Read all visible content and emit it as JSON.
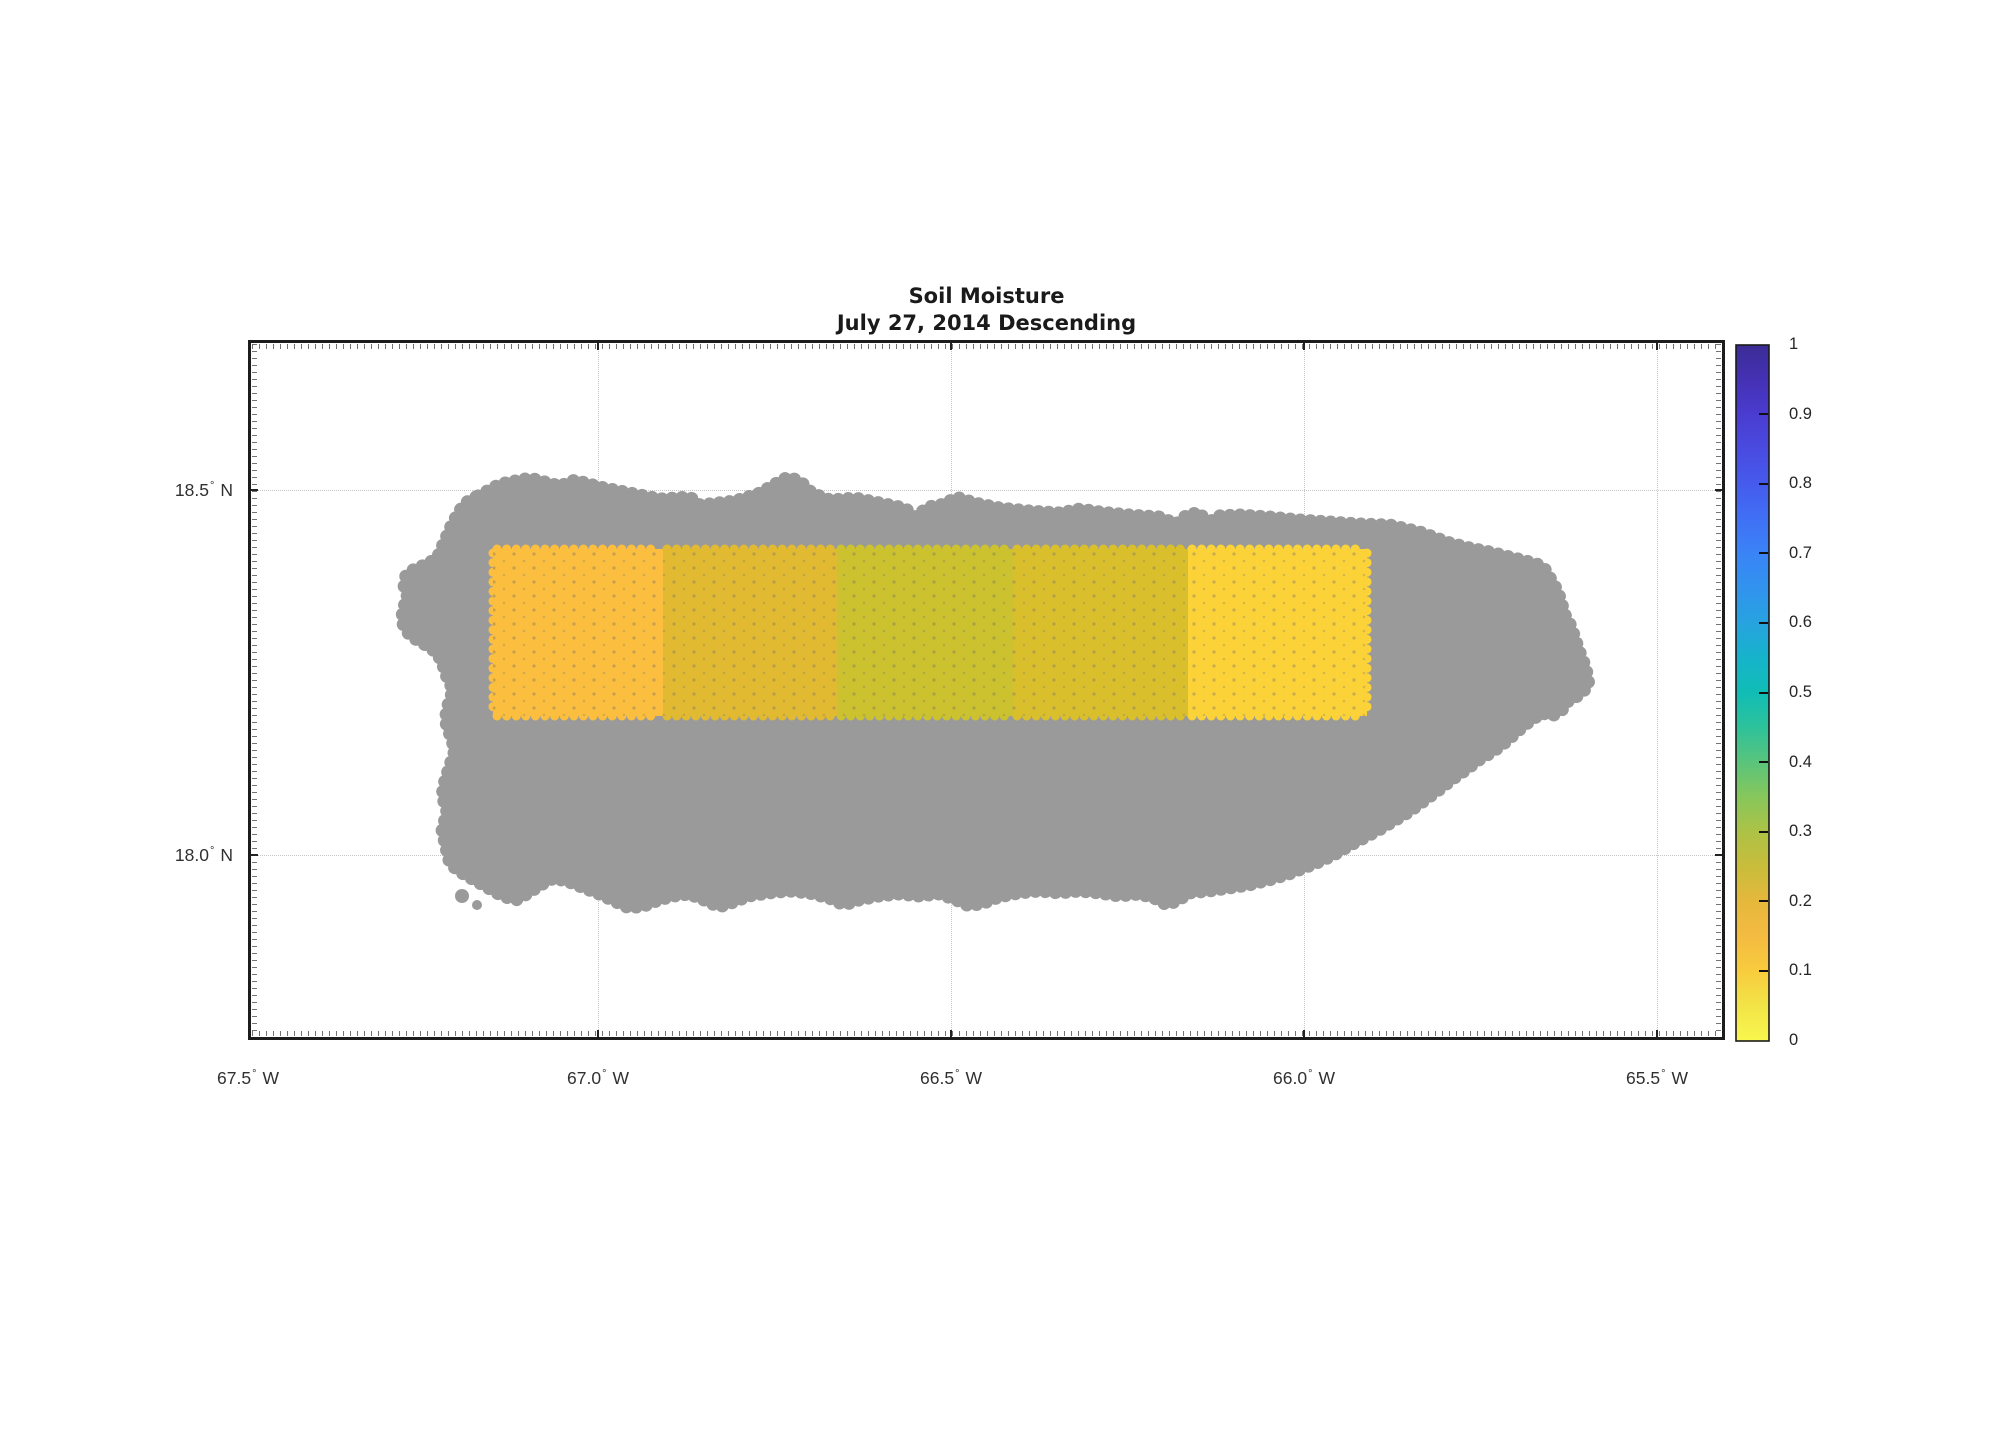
{
  "chart_data": {
    "type": "heatmap",
    "title": "Soil Moisture",
    "subtitle": "July 27, 2014 Descending",
    "map_region": "Puerto Rico coastline (gray land mask)",
    "land_color": "#9a9a9a",
    "background_color": "#ffffff",
    "frame_color": "#1c1c1c",
    "grid_color": "#c6c6c6",
    "axes": {
      "degree": "°",
      "x_ticks": [
        {
          "deg": "67.5",
          "hemi": "W"
        },
        {
          "deg": "67.0",
          "hemi": "W"
        },
        {
          "deg": "66.5",
          "hemi": "W"
        },
        {
          "deg": "66.0",
          "hemi": "W"
        },
        {
          "deg": "65.5",
          "hemi": "W"
        }
      ],
      "y_ticks": [
        {
          "deg": "18.5",
          "hemi": "N"
        },
        {
          "deg": "18.0",
          "hemi": "N"
        }
      ],
      "x_range_deg_w": [
        67.5,
        65.41
      ],
      "y_range_deg_n": [
        17.75,
        18.71
      ],
      "grid": "dotted"
    },
    "cells": [
      {
        "lon_w": [
          67.15,
          66.9
        ],
        "lat_n": [
          18.19,
          18.42
        ],
        "value": 0.18,
        "color": "#fbbe3e"
      },
      {
        "lon_w": [
          66.9,
          66.65
        ],
        "lat_n": [
          18.19,
          18.42
        ],
        "value": 0.22,
        "color": "#e2ba32"
      },
      {
        "lon_w": [
          66.65,
          66.4
        ],
        "lat_n": [
          18.19,
          18.42
        ],
        "value": 0.26,
        "color": "#ccc12e"
      },
      {
        "lon_w": [
          66.4,
          66.15
        ],
        "lat_n": [
          18.19,
          18.42
        ],
        "value": 0.24,
        "color": "#dabf2d"
      },
      {
        "lon_w": [
          66.15,
          65.9
        ],
        "lat_n": [
          18.19,
          18.42
        ],
        "value": 0.12,
        "color": "#fbd238"
      }
    ],
    "colorbar": {
      "min": 0,
      "max": 1,
      "colormap": "parula (reversed: yellow low, indigo high)",
      "tick_labels": [
        "1",
        "0.9",
        "0.8",
        "0.7",
        "0.6",
        "0.5",
        "0.4",
        "0.3",
        "0.2",
        "0.1",
        "0"
      ],
      "gradient_stops_bottom_to_top": [
        "#f9f74e",
        "#f2e447",
        "#f8cc3e",
        "#f4bb41",
        "#e5b83c",
        "#c9bd3b",
        "#adc246",
        "#87c75b",
        "#5ac47b",
        "#2ec29b",
        "#10bdb5",
        "#16b3cb",
        "#27a3df",
        "#3193ee",
        "#3a84f6",
        "#4070f5",
        "#455bec",
        "#4a4be0",
        "#4a3cd0",
        "#4531b4",
        "#3b2c96"
      ]
    }
  }
}
